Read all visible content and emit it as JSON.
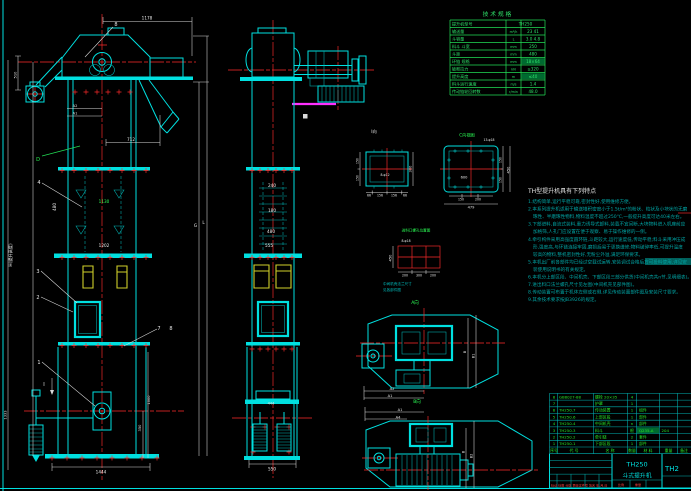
{
  "front_view": {
    "dims": {
      "top_width": "1178",
      "chute_offset": "712",
      "a2": "A2",
      "a1": "A1",
      "head_left": "510",
      "mid_pitch": "480",
      "mid_green": "1130",
      "lower_pitch": "1202",
      "base_width": "1444",
      "boot_height": "1000",
      "boot_inner": "350",
      "boot_left": "1333",
      "lift_height": "H(提升高度)",
      "g": "G",
      "l": "L"
    },
    "labels": {
      "n8": "8",
      "n4": "4",
      "n3": "3",
      "n2": "2",
      "n1": "1",
      "n7": "7",
      "n7b": "8",
      "d": "D",
      "section_i": "I"
    }
  },
  "side_view": {
    "dims": {
      "top": "240",
      "mid": "180",
      "pitch": "480",
      "lower": "555",
      "boot": "444",
      "base": "550"
    }
  },
  "spec_table": {
    "title": "技 术 规 格",
    "rows": [
      {
        "label": "提升机型号",
        "unit": "",
        "value": "TH250"
      },
      {
        "label": "输送量",
        "unit": "m³/h",
        "value": "23  41"
      },
      {
        "label": "斗容量",
        "unit": "L",
        "value": "3.0  4.8"
      },
      {
        "label": "料斗  斗宽",
        "unit": "mm",
        "value": "250"
      },
      {
        "label": "斗距",
        "unit": "mm",
        "value": "480"
      },
      {
        "label": "环链  规格",
        "unit": "mm",
        "value": "18×64"
      },
      {
        "label": "破断拉力",
        "unit": "kN",
        "value": "≥320"
      },
      {
        "label": "提升高度",
        "unit": "m",
        "value": "≤40"
      },
      {
        "label": "料斗运行速度",
        "unit": "m/s",
        "value": "1.4"
      },
      {
        "label": "传动链轮回转数",
        "unit": "r/min",
        "value": "48.0"
      }
    ]
  },
  "details": {
    "view_i": {
      "title": "I向",
      "holes": "8-φ12",
      "right": "300",
      "left1": "150",
      "left2": "150",
      "b1": "66",
      "b2": "156",
      "b3": "156",
      "b4": "66"
    },
    "view_c": {
      "title": "C向视图",
      "holes": "13-φ18",
      "inner": "600",
      "r1": "150",
      "r2": "150",
      "r_total": "450",
      "b1": "150",
      "b2": "200",
      "b_total": "479"
    },
    "inlet": {
      "title": "进料口螺孔位置图",
      "holes": "8-φ18",
      "left": "450",
      "b1": "200",
      "b2": "300",
      "b3": "200",
      "note1": "中间机壳法兰尺寸",
      "note2": "见各部件图"
    },
    "view_a": {
      "label": "A向",
      "a2": "A2",
      "a1": "A1",
      "b": "B",
      "b1": "B1"
    },
    "view_b": {
      "label": "B向",
      "a1": "A1",
      "a4": "A4",
      "b": "B",
      "b2": "B2"
    }
  },
  "features": {
    "title": "TH型提升机具有下列特点",
    "lines": [
      "1.结构简单,运行平稳可靠,密封性好,使用维修方便。",
      "2.本系列提升机适用于输送堆积密度小于1.5t/m³的粉状、粒状及小块状的无磨",
      "琢性、半磨琢性物料,物料温度不超过250℃,一般提升高度可达40米左右。",
      "3.下部进料,自流式装料,重力诱导式卸料,装载不宜间断,大块物料进入机座前应",
      "加格筛,人孔门应设置在便于观察、易于操作维修的一侧。",
      "4.牵引构件采用高强度圆环链,斗距较大,运行速度低,传动平稳;料斗采用冲压成",
      "形,强度高,与环链连接牢固,磨损后易于更换维修;物料破碎率低,可提升温度",
      "较高的物料,整机密封性好,无粉尘外溢,满足环保要求。",
      "5.本机出厂前各部件均已经过空载试运转,安装调试合格后方可投料使用,详见安",
      "装使用说明书的有关规定。",
      "6.本机分上部区段、中间机壳、下部区段三部分供货(中间机壳共n节,见明细表)。",
      "7.进出料口法兰螺孔尺寸见左图(中间机壳见部件图)。",
      "8.传动装置可布置于机体左侧或右侧,详见传动装置部件图及安装尺寸要求。",
      "9.其余技术要求按JB3926的规定。"
    ]
  },
  "parts_list": {
    "header": [
      "序号",
      "代 号",
      "名 称",
      "数量",
      "材 料",
      "重量",
      "备注"
    ],
    "rows": [
      [
        "8",
        "GB8027-88",
        "螺栓 20×35",
        "4",
        "",
        ""
      ],
      [
        "7",
        "",
        "护罩",
        "1",
        "",
        ""
      ],
      [
        "6",
        "TH250.7",
        "传动装置",
        "1",
        "组件",
        ""
      ],
      [
        "5",
        "TH250.6",
        "上部区段",
        "1",
        "部件",
        ""
      ],
      [
        "4",
        "TH250.4",
        "中间机壳",
        "n",
        "部件",
        ""
      ],
      [
        "3",
        "TH250.3",
        "料斗",
        "根",
        "Q235-A",
        "204"
      ],
      [
        "2",
        "TH250.2",
        "牵引链",
        "2",
        "套件",
        ""
      ],
      [
        "1",
        "TH250.1",
        "下部区段",
        "1",
        "部件",
        ""
      ]
    ]
  },
  "title_block": {
    "model": "TH250",
    "product": "斗式提升机",
    "drawing_no": "TH2",
    "rev_row": "标记 处数 分区 更改文件号 签名 年.月.日",
    "scale_label": "比例",
    "weight_label": "重量"
  }
}
